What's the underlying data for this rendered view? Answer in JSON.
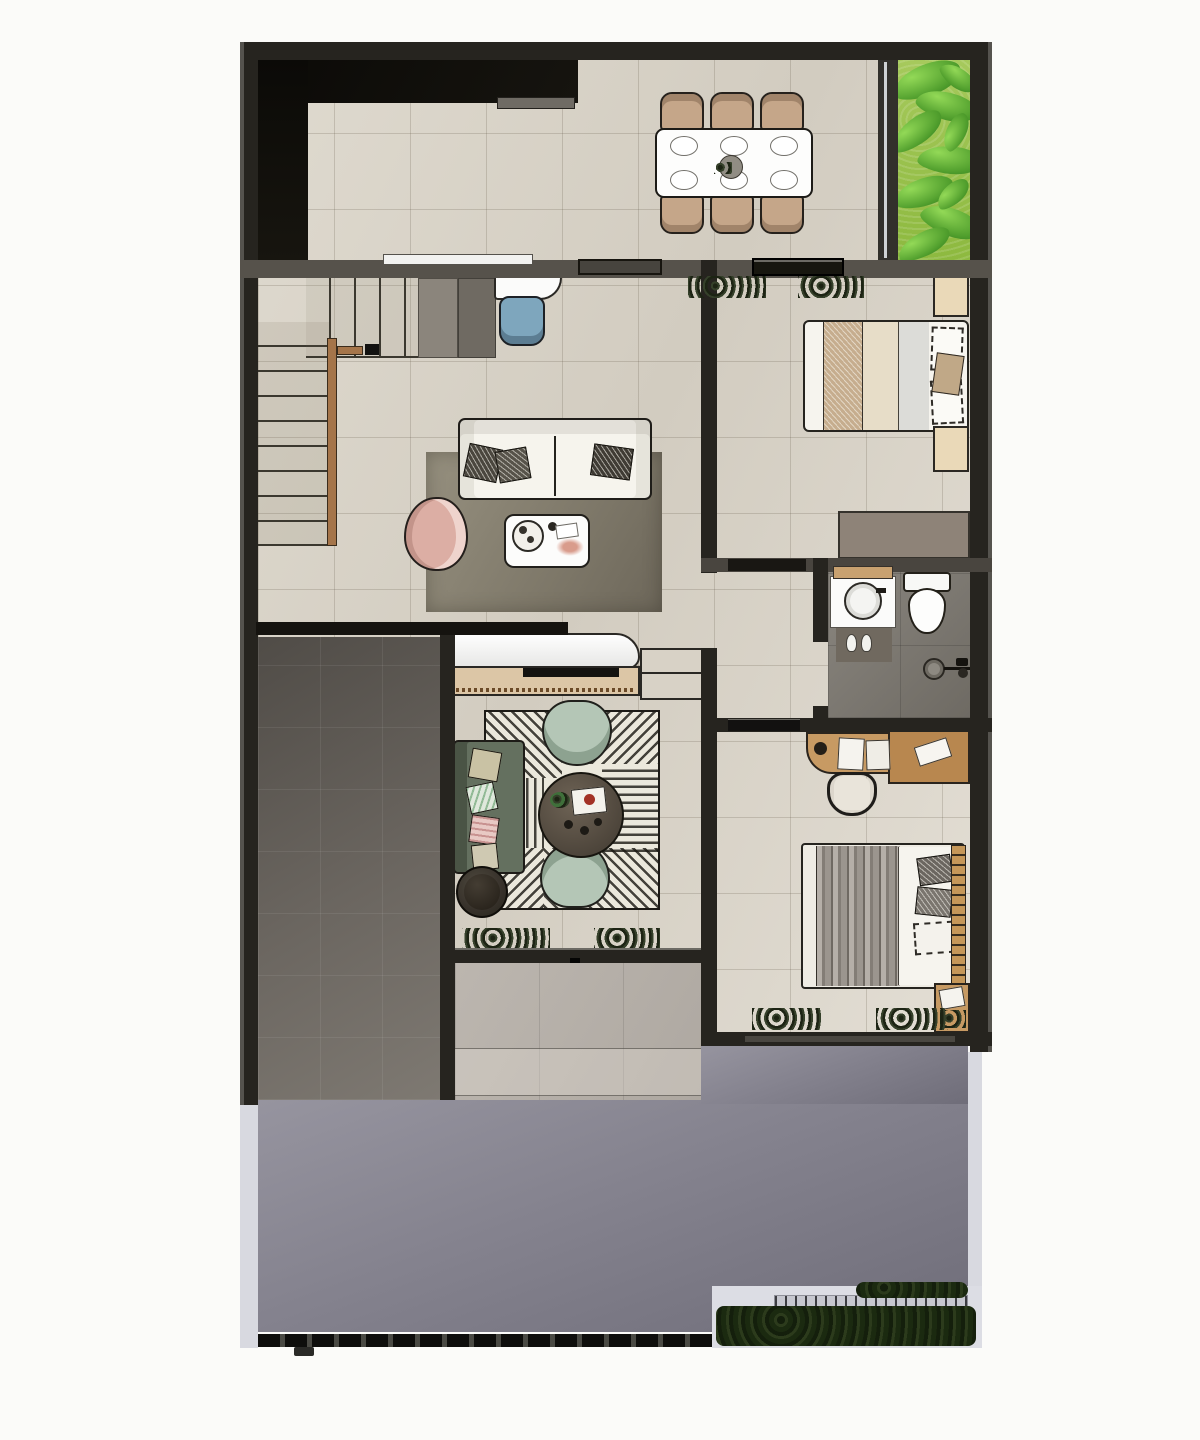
{
  "meta": {
    "kind": "architectural-floor-plan",
    "view": "top-down-render",
    "floor": "ground"
  },
  "palette": {
    "background": "#fbfbf9",
    "wall_dark": "#26241f",
    "wall_gray": "#56524b",
    "void_black": "#0b0a07",
    "tile_beige": "#d8d2c6",
    "patio_gray": "#6b6660",
    "bath_gray": "#7b766f",
    "walkway_gray": "#b7b1ab",
    "driveway_concrete": "#84828e",
    "sidewalk": "#d8d9e0",
    "grass_green": "#9fc353",
    "plant_green": "#4d9a2b",
    "shrub_dark": "#273518",
    "wood": "#c79a63",
    "wood_dark": "#8a6a3e",
    "rail_wood": "#a5754a",
    "sofa_white": "#f6f4ed",
    "rug_living": "#857f70",
    "rug_lounge": "#ebe8dc",
    "stripe_dark": "#1e1c18",
    "armchair_pink": "#dcaea4",
    "armchair_sage": "#b4c6b6",
    "sofa_sage": "#64705f",
    "chair_tan": "#c5a689",
    "chair_blue": "#7ea6bd",
    "bed_white": "#f6f4ee",
    "blanket_tan": "#c6ad8e",
    "blanket_gray": "#8d8780",
    "nightstand_light": "#ead9b8",
    "wardrobe_gray": "#8e8378",
    "fixture_white": "#fbfbfa",
    "tv_black": "#141310",
    "fence_light": "#c6c7cf",
    "table_white": "#fdfdfc",
    "coffee_table_dark": "#5a5146"
  },
  "rooms": {
    "dining": {
      "label": "dining-area",
      "items": [
        "dining-table",
        "dining-chairs-x6",
        "place-settings-x6",
        "centerpiece"
      ]
    },
    "garden": {
      "label": "side-garden",
      "items": [
        "lawn",
        "tropical-plants"
      ]
    },
    "living": {
      "label": "living-area",
      "items": [
        "sofa-3-seat",
        "throw-pillows-x3",
        "area-rug",
        "coffee-table",
        "round-tray",
        "accent-armchair",
        "desk-nook",
        "desk-chair",
        "storage-cabinets"
      ]
    },
    "stairs": {
      "label": "staircase",
      "items": [
        "lower-flight",
        "upper-flight",
        "wood-handrail"
      ]
    },
    "bedroom1": {
      "label": "bedroom-1",
      "items": [
        "double-bed",
        "pillows",
        "nightstand-x2",
        "wardrobe",
        "indoor-plants"
      ]
    },
    "bathroom": {
      "label": "bathroom",
      "items": [
        "vanity-sink",
        "toilet",
        "shower-drain",
        "shower-head",
        "bath-mat",
        "slippers"
      ]
    },
    "hallway": {
      "label": "hallway",
      "items": [
        "door-panel"
      ]
    },
    "lounge": {
      "label": "family-lounge",
      "items": [
        "sofa",
        "accent-armchair-x2",
        "round-coffee-table",
        "patterned-rug",
        "tv-console",
        "tv",
        "side-pouf",
        "floor-plants"
      ]
    },
    "bedroom2": {
      "label": "bedroom-2",
      "items": [
        "double-bed",
        "desk",
        "desk-chair",
        "books",
        "nightstand",
        "indoor-plants"
      ]
    },
    "patio": {
      "label": "side-patio",
      "items": [
        "stone-tiles"
      ]
    },
    "walkway": {
      "label": "entry-walkway",
      "items": []
    },
    "driveway": {
      "label": "driveway-carport",
      "items": [
        "entry-gate",
        "gate-post"
      ]
    },
    "planter": {
      "label": "front-planter",
      "items": [
        "hedge-shrubs",
        "slat-fence"
      ]
    },
    "void": {
      "label": "kitchen-void",
      "items": []
    }
  },
  "counts": {
    "bedrooms": 2,
    "bathrooms": 1,
    "dining_seats": 6,
    "dining_place_settings": 6
  }
}
